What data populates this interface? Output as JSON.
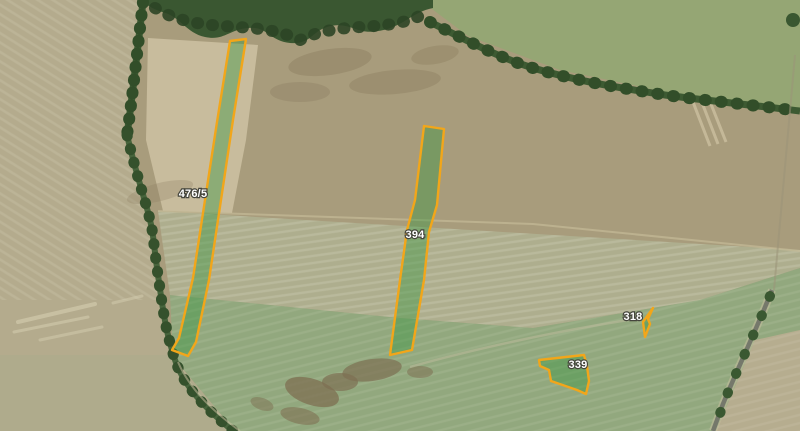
{
  "theme": {
    "parcel-outline": "#f2a61a",
    "parcel-fill": "rgba(57,150,64,0.42)",
    "label-color": "#ffffff",
    "label-halo": "#45453c"
  },
  "parcels": [
    {
      "label": "476/5",
      "points": "230,41 246,39 233,120 221,200 209,280 196,342 188,356 172,350 179,338 193,278 205,200 217,122",
      "label_x": "193",
      "label_y": "197"
    },
    {
      "label": "394",
      "points": "424,126 444,129 437,205 429,232 424,280 412,350 390,355 400,280 407,230 415,200",
      "label_x": "415",
      "label_y": "238"
    },
    {
      "label": "318",
      "points": "653,308 643,322 645,337 650,324 648,319",
      "label_x": "633",
      "label_y": "320"
    },
    {
      "label": "339",
      "points": "539,360 584,355 587,366 589,381 586,394 577,390 551,381 549,370 540,366",
      "label_x": "578",
      "label_y": "368"
    }
  ]
}
